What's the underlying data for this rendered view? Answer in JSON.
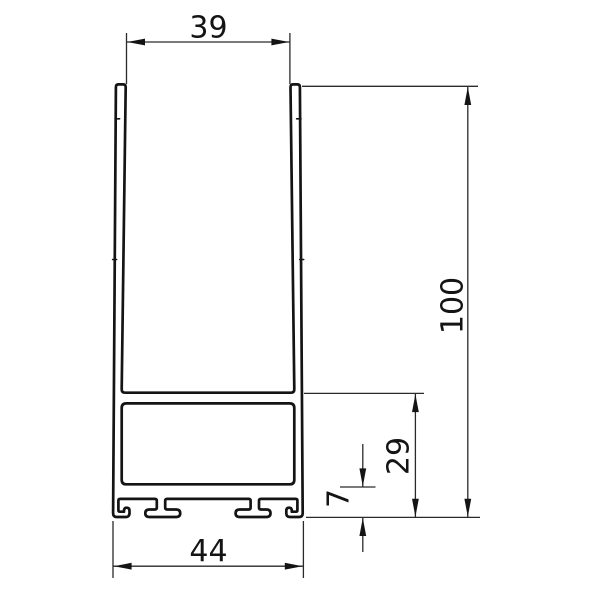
{
  "page": {
    "background": "#ffffff",
    "line_color": "#141414"
  },
  "drawing": {
    "name": "aluminium-profile-cross-section",
    "dimensions": {
      "top_width": "39",
      "overall_height": "100",
      "lower_section_height": "29",
      "foot_height": "7",
      "bottom_width": "44"
    }
  }
}
